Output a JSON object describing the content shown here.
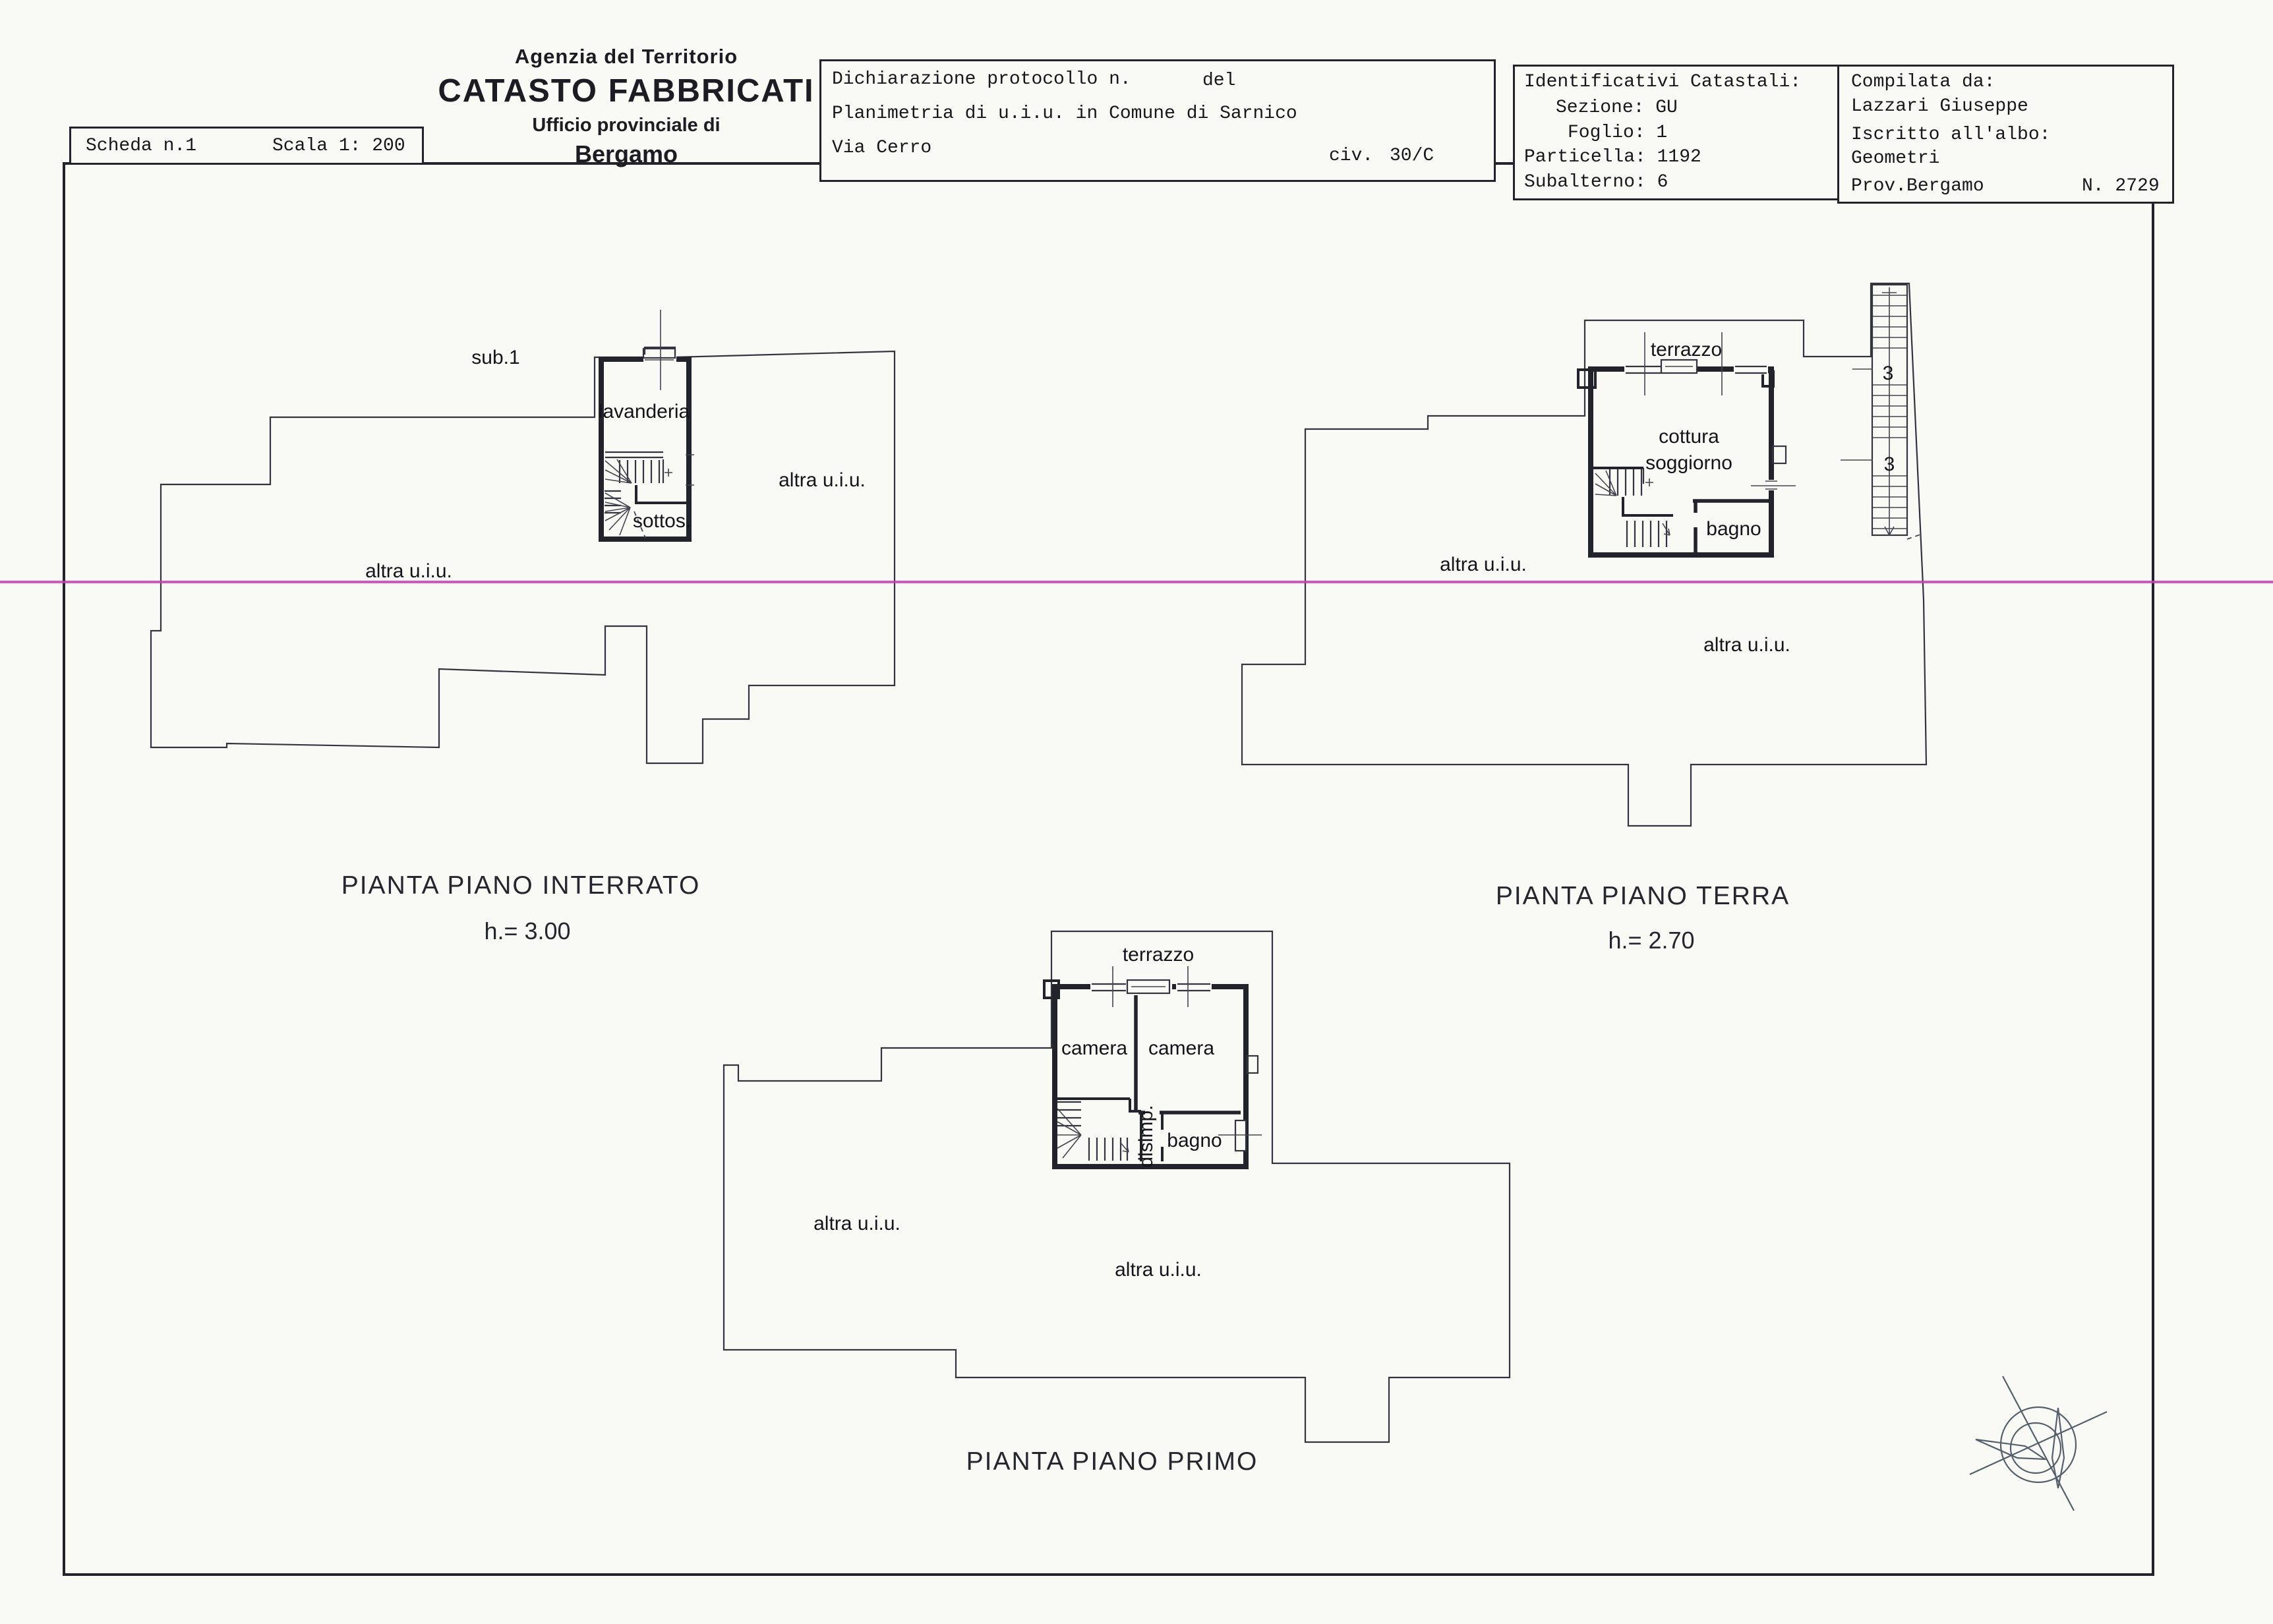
{
  "header": {
    "agency_line1": "Agenzia del Territorio",
    "agency_line2": "CATASTO FABBRICATI",
    "agency_line3": "Ufficio provinciale di",
    "agency_line4": "Bergamo"
  },
  "boxes": {
    "sheet": {
      "scheda": "Scheda n.1",
      "scala": "Scala 1: 200"
    },
    "declaration": {
      "protocollo": "Dichiarazione protocollo n.",
      "del": "del",
      "planimetria": "Planimetria di u.i.u. in Comune di Sarnico",
      "street": "Via Cerro",
      "civ_label": "civ.",
      "civ_value": "30/C"
    },
    "cadastral": {
      "title": "Identificativi Catastali:",
      "sezione": "Sezione: GU",
      "foglio": "Foglio: 1",
      "particella": "Particella: 1192",
      "subalterno": "Subalterno: 6"
    },
    "compiler": {
      "title": "Compilata da:",
      "name": "Lazzari Giuseppe",
      "albo_label": "Iscritto all'albo:",
      "albo_value": "Geometri",
      "prov": "Prov.Bergamo",
      "number": "N. 2729"
    }
  },
  "plans": {
    "interrato": {
      "title": "PIANTA PIANO INTERRATO",
      "height": "h.= 3.00",
      "labels": {
        "sub": "sub.1",
        "lavanderia": "lavanderia",
        "sottos": "sottos.",
        "altra1": "altra u.i.u.",
        "altra2": "altra u.i.u."
      }
    },
    "terra": {
      "title": "PIANTA PIANO TERRA",
      "height": "h.= 2.70",
      "labels": {
        "terrazzo": "terrazzo",
        "cottura": "cottura",
        "soggiorno": "soggiorno",
        "bagno": "bagno",
        "level3a": "3",
        "level3b": "3",
        "altra1": "altra u.i.u.",
        "altra2": "altra u.i.u."
      }
    },
    "primo": {
      "title": "PIANTA PIANO PRIMO",
      "labels": {
        "terrazzo": "terrazzo",
        "camera1": "camera",
        "camera2": "camera",
        "disimp": "disimp.",
        "bagno": "bagno",
        "altra1": "altra u.i.u.",
        "altra2": "altra u.i.u."
      }
    }
  },
  "colors": {
    "scan_line": "#cb3cb0",
    "ink": "#23232b"
  }
}
